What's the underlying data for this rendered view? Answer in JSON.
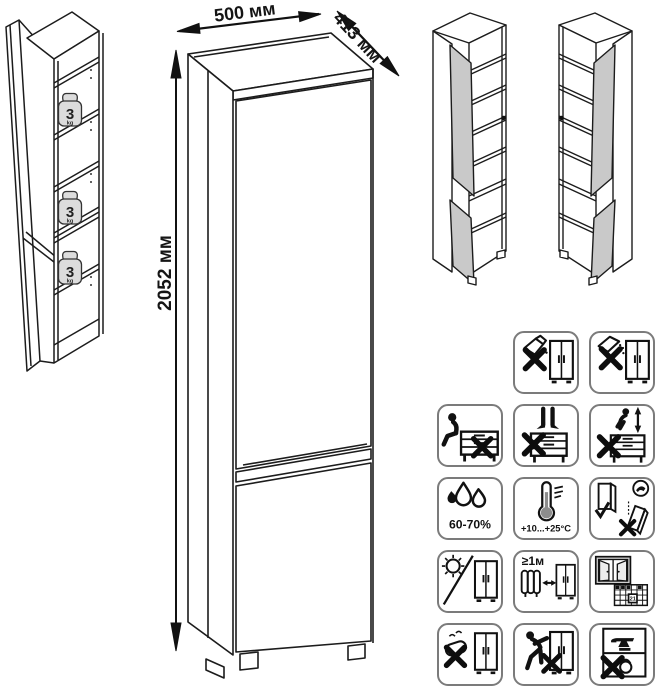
{
  "product_drawing": {
    "dimensions": {
      "width_label": "500 мм",
      "depth_label": "413 мм",
      "height_label": "2052 мм"
    },
    "shelf_load": {
      "value": "3",
      "unit": "kg"
    }
  },
  "care_panel": {
    "cells": {
      "no_liquids": {
        "icon": "no-pouring-liquid-icon"
      },
      "no_powder": {
        "icon": "no-spilling-powder-icon"
      },
      "no_sitting": {
        "icon": "no-sitting-icon"
      },
      "no_standing": {
        "icon": "no-standing-icon"
      },
      "no_jumping": {
        "icon": "no-jumping-icon"
      },
      "humidity": {
        "icon": "humidity-icon",
        "label": "60-70%"
      },
      "temperature": {
        "icon": "temperature-icon",
        "label": "+10...+25°C"
      },
      "keep_upright": {
        "icon": "keep-upright-icon"
      },
      "no_sunlight": {
        "icon": "no-direct-sunlight-icon"
      },
      "heat_distance": {
        "icon": "heat-distance-icon",
        "label": "≥1м"
      },
      "ventilation": {
        "icon": "ventilate-room-icon",
        "calendar_day": "21"
      },
      "no_abrasive": {
        "icon": "no-abrasive-cleaning-icon"
      },
      "no_dragging": {
        "icon": "no-dragging-icon"
      },
      "no_overload": {
        "icon": "no-overload-icon"
      }
    }
  }
}
